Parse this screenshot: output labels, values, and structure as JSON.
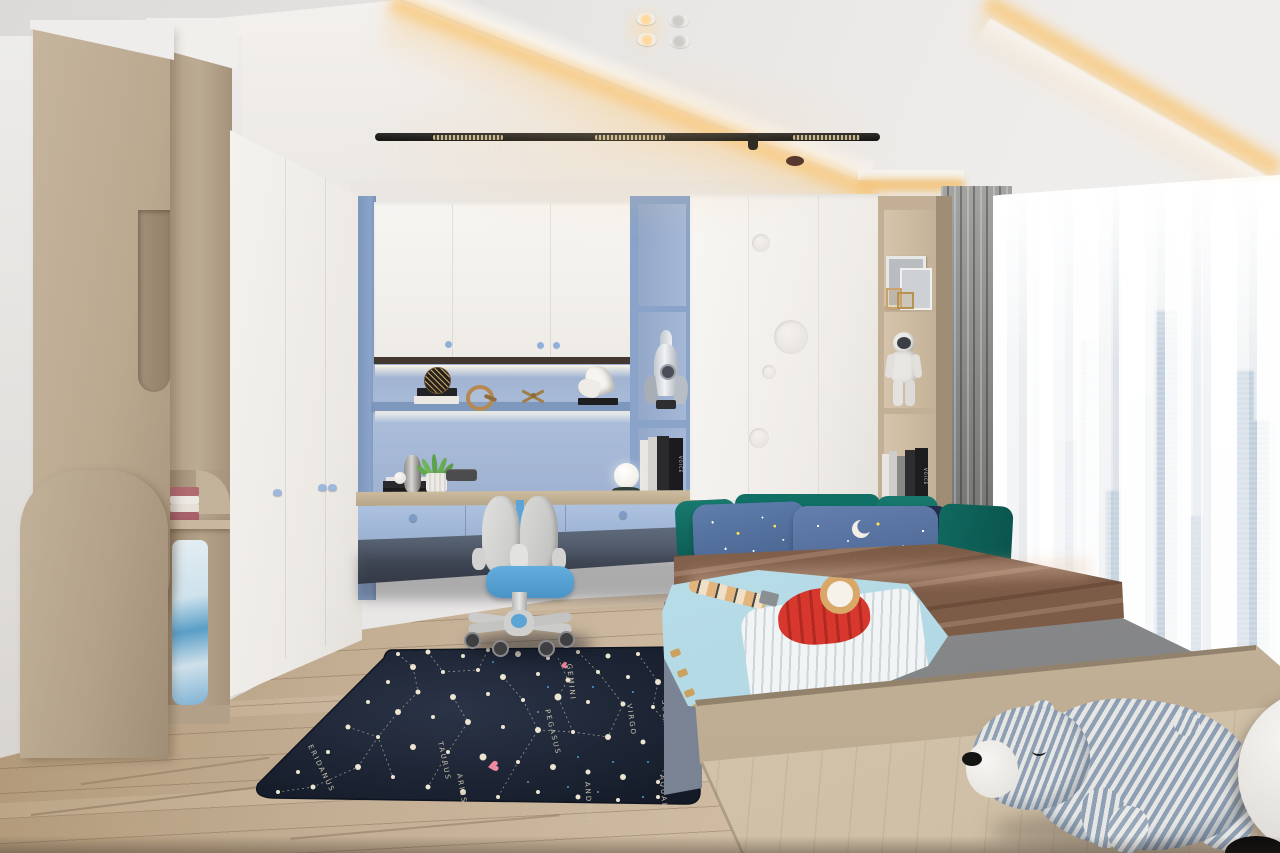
{
  "rug": {
    "theme": "constellation-map",
    "base_color": "#1c2433",
    "heart_glyph": "♥",
    "labels": [
      {
        "text": "GEMINI",
        "x": 329,
        "y": 22,
        "rot": 84
      },
      {
        "text": "SCORPIO",
        "x": 424,
        "y": 58,
        "rot": 86
      },
      {
        "text": "VIRGO",
        "x": 389,
        "y": 62,
        "rot": 82
      },
      {
        "text": "PEGASUS",
        "x": 307,
        "y": 68,
        "rot": 76
      },
      {
        "text": "TAURUS",
        "x": 200,
        "y": 100,
        "rot": 78
      },
      {
        "text": "ARIES",
        "x": 219,
        "y": 132,
        "rot": 80
      },
      {
        "text": "ERIDANUS",
        "x": 70,
        "y": 104,
        "rot": 64
      },
      {
        "text": "ANDROMEDA",
        "x": 347,
        "y": 140,
        "rot": 86
      },
      {
        "text": "AQUARIUS",
        "x": 422,
        "y": 133,
        "rot": 86
      }
    ],
    "stars": [
      [
        160,
        12,
        2
      ],
      [
        190,
        10,
        2.5
      ],
      [
        225,
        14,
        2
      ],
      [
        250,
        8,
        2
      ],
      [
        280,
        12,
        3
      ],
      [
        310,
        16,
        2
      ],
      [
        340,
        10,
        2
      ],
      [
        370,
        14,
        2.5
      ],
      [
        400,
        12,
        2
      ],
      [
        430,
        18,
        2
      ],
      [
        445,
        30,
        2
      ],
      [
        175,
        25,
        3
      ],
      [
        205,
        30,
        2
      ],
      [
        240,
        28,
        2
      ],
      [
        265,
        35,
        3
      ],
      [
        300,
        32,
        2
      ],
      [
        330,
        38,
        2.5
      ],
      [
        360,
        30,
        2
      ],
      [
        390,
        35,
        2
      ],
      [
        420,
        40,
        3
      ],
      [
        150,
        40,
        2
      ],
      [
        180,
        50,
        2.5
      ],
      [
        215,
        55,
        3
      ],
      [
        250,
        52,
        2
      ],
      [
        285,
        58,
        2
      ],
      [
        320,
        55,
        3.5
      ],
      [
        350,
        60,
        2
      ],
      [
        385,
        62,
        2.5
      ],
      [
        415,
        65,
        2
      ],
      [
        445,
        60,
        2
      ],
      [
        130,
        60,
        2
      ],
      [
        160,
        70,
        3
      ],
      [
        195,
        75,
        2
      ],
      [
        230,
        80,
        3
      ],
      [
        265,
        85,
        2
      ],
      [
        300,
        88,
        3
      ],
      [
        335,
        90,
        2
      ],
      [
        370,
        95,
        3
      ],
      [
        405,
        100,
        2.5
      ],
      [
        440,
        95,
        2
      ],
      [
        110,
        85,
        2.5
      ],
      [
        140,
        95,
        2
      ],
      [
        175,
        105,
        3
      ],
      [
        210,
        110,
        2
      ],
      [
        245,
        115,
        3.5
      ],
      [
        280,
        120,
        2
      ],
      [
        315,
        125,
        3
      ],
      [
        350,
        130,
        2.5
      ],
      [
        385,
        135,
        3
      ],
      [
        420,
        140,
        2
      ],
      [
        90,
        110,
        2
      ],
      [
        120,
        125,
        3
      ],
      [
        155,
        135,
        2
      ],
      [
        190,
        145,
        2.5
      ],
      [
        225,
        150,
        3
      ],
      [
        260,
        155,
        2
      ],
      [
        300,
        150,
        2
      ],
      [
        340,
        155,
        2.5
      ],
      [
        380,
        158,
        2
      ],
      [
        420,
        155,
        2
      ],
      [
        60,
        130,
        2
      ],
      [
        75,
        145,
        2.5
      ],
      [
        40,
        150,
        2
      ]
    ],
    "speckles": [
      [
        255,
        20
      ],
      [
        310,
        45
      ],
      [
        355,
        45
      ],
      [
        395,
        50
      ],
      [
        430,
        75
      ],
      [
        300,
        70
      ],
      [
        340,
        115
      ],
      [
        375,
        120
      ],
      [
        410,
        120
      ],
      [
        290,
        140
      ],
      [
        330,
        145
      ],
      [
        440,
        130
      ],
      [
        360,
        150
      ],
      [
        405,
        155
      ]
    ],
    "lines": [
      [
        [
          160,
          12
        ],
        [
          175,
          25
        ],
        [
          180,
          50
        ],
        [
          160,
          70
        ],
        [
          140,
          95
        ],
        [
          120,
          125
        ],
        [
          75,
          145
        ],
        [
          40,
          150
        ]
      ],
      [
        [
          190,
          10
        ],
        [
          205,
          30
        ],
        [
          240,
          28
        ],
        [
          250,
          8
        ]
      ],
      [
        [
          215,
          55
        ],
        [
          230,
          80
        ],
        [
          210,
          110
        ],
        [
          190,
          145
        ]
      ],
      [
        [
          265,
          35
        ],
        [
          285,
          58
        ],
        [
          300,
          88
        ],
        [
          280,
          120
        ],
        [
          260,
          155
        ]
      ],
      [
        [
          300,
          88
        ],
        [
          335,
          90
        ],
        [
          370,
          95
        ]
      ],
      [
        [
          340,
          10
        ],
        [
          360,
          30
        ],
        [
          385,
          62
        ],
        [
          370,
          95
        ]
      ],
      [
        [
          400,
          12
        ],
        [
          420,
          40
        ],
        [
          415,
          65
        ],
        [
          440,
          95
        ],
        [
          420,
          140
        ]
      ],
      [
        [
          430,
          18
        ],
        [
          445,
          30
        ],
        [
          445,
          60
        ]
      ],
      [
        [
          110,
          85
        ],
        [
          140,
          95
        ],
        [
          155,
          135
        ]
      ],
      [
        [
          320,
          16
        ],
        [
          330,
          38
        ],
        [
          320,
          55
        ],
        [
          335,
          90
        ]
      ]
    ],
    "hearts": [
      [
        322,
        20,
        9
      ],
      [
        249,
        119,
        14
      ]
    ]
  },
  "city": {
    "buildings": [
      [
        8,
        20,
        140
      ],
      [
        34,
        16,
        40
      ],
      [
        58,
        22,
        190
      ],
      [
        84,
        18,
        95
      ],
      [
        108,
        26,
        10
      ],
      [
        140,
        15,
        215
      ],
      [
        162,
        22,
        150
      ],
      [
        188,
        18,
        70
      ],
      [
        206,
        21,
        120
      ]
    ]
  },
  "track": {
    "segments": [
      [
        58,
        70
      ],
      [
        220,
        70
      ],
      [
        418,
        67
      ]
    ]
  },
  "books": {
    "spine_text": "VOICE",
    "spine_text_2": "VOICE"
  },
  "palette": {
    "wood": "#c2b098",
    "wood_dark": "#a08a72",
    "blue_cabinet": "#8aa3c8",
    "blue_panel": "#a9bcd9",
    "drawer_blue": "#a9bedd",
    "white_door": "#f3f1ee",
    "cove_glow": "#f7c87e",
    "teal_pillow": "#15756b",
    "star_pillow_blue": "#5b7aa8",
    "navy_pillow": "#222e4d",
    "brown_blanket": "#8a6751",
    "mattress_gray": "#8f9092",
    "kids_blanket": "#c7e4ec",
    "rug_navy": "#1c2433",
    "floor": "#c7b298",
    "platform": "#d6c8b1",
    "chair_seat_blue": "#57a0d4",
    "chair_gray": "#d4d4d2",
    "curtain_gray": "#8a8a88",
    "city_blue": "#b5c7d9",
    "star_dot": "#ece5d2",
    "heart_pink": "#f08aa0"
  }
}
